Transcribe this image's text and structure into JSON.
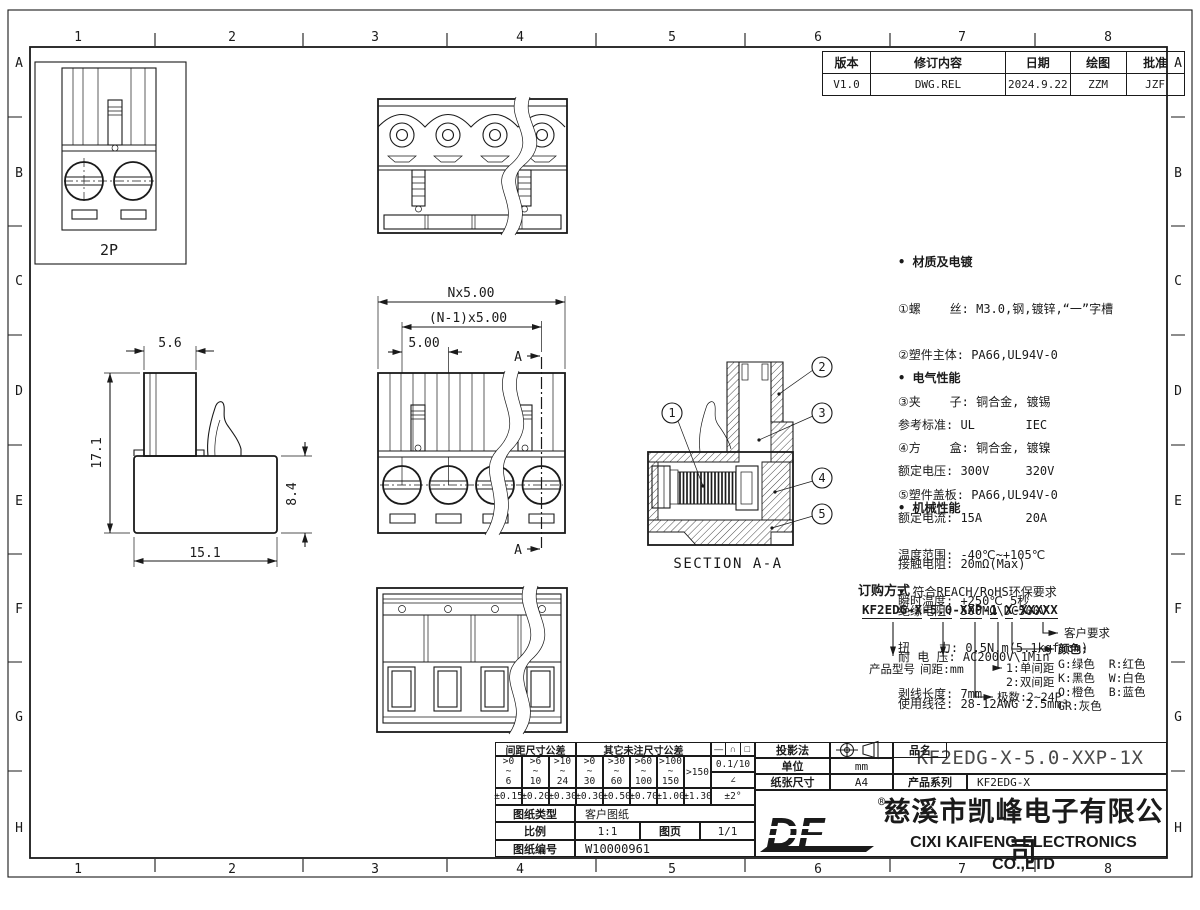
{
  "colors": {
    "ink": "#1a1a1a",
    "paper": "#ffffff",
    "muted": "#4a4a4a"
  },
  "grid": {
    "cols": [
      "1",
      "2",
      "3",
      "4",
      "5",
      "6",
      "7",
      "8"
    ],
    "rows": [
      "A",
      "B",
      "C",
      "D",
      "E",
      "F",
      "G",
      "H"
    ]
  },
  "revision": {
    "headers": [
      "版本",
      "修订内容",
      "日期",
      "绘图",
      "批准"
    ],
    "row": [
      "V1.0",
      "DWG.REL",
      "2024.9.22",
      "ZZM",
      "JZF"
    ]
  },
  "views": {
    "pole_label": "2P",
    "dim_top_width": "5.6",
    "dim_height": "17.1",
    "dim_body_height": "8.4",
    "dim_body_width": "15.1",
    "dim_overall": "Nx5.00",
    "dim_span": "(N-1)x5.00",
    "dim_pitch": "5.00",
    "section_mark": "A",
    "section_title": "SECTION A-A",
    "callouts": [
      "1",
      "2",
      "3",
      "4",
      "5"
    ]
  },
  "notes": {
    "bullet": "•",
    "material_title": "材质及电镀",
    "material_lines": [
      "①螺    丝: M3.0,钢,镀锌,“一”字槽",
      "②塑件主体: PA66,UL94V-0",
      "③夹    子: 铜合金, 镀锡",
      "④方    盒: 铜合金, 镀镍",
      "⑤塑件盖板: PA66,UL94V-0"
    ],
    "electrical_title": "电气性能",
    "electrical_lines": [
      "参考标准: UL       IEC",
      "额定电压: 300V     320V",
      "额定电流: 15A      20A",
      "接触电阻: 20mΩ(Max)",
      "绝缘电阻: 500MΩ\\DC500V",
      "耐 电 压: AC2000V\\1Min",
      "使用线径: 28-12AWG 2.5mm²"
    ],
    "mechanical_title": "机械性能",
    "mechanical_lines": [
      "温度范围: -40℃~+105℃",
      "瞬时温度: +250℃ 5秒",
      "扭    力: 0.5N.m(5.1kgf.cm)",
      "剥线长度: 7mm"
    ],
    "compliance": "符合REACH/RoHS环保要求"
  },
  "ordering": {
    "title": "订购方式",
    "part_segments": [
      "KF2EDG-X",
      "5.0",
      "XXP",
      "1",
      "X",
      "XXXXX"
    ],
    "dash": "-",
    "space": " ",
    "customer": "客户要求",
    "color_title": "颜色:",
    "color_lines": [
      "G:绿色  R:红色",
      "K:黑色  W:白色",
      "O:橙色  B:蓝色",
      "GR:灰色"
    ],
    "pitch_single": "1:单间距",
    "pitch_double": "2:双间距",
    "poles": "极数:2~24P",
    "model": "产品型号",
    "pitch_unit": "间距:mm"
  },
  "title_block": {
    "tol_pitch_header": "间距尺寸公差",
    "tol_other_header": "其它未注尺寸公差",
    "range_tops": [
      ">0",
      ">6",
      ">10",
      ">0",
      ">30",
      ">60",
      ">100"
    ],
    "tilde": "~",
    "range_bots": [
      "6",
      "10",
      "24",
      "30",
      "60",
      "100",
      "150"
    ],
    "range_over": ">150",
    "tols": [
      "±0.15",
      "±0.20",
      "±0.30",
      "±0.30",
      "±0.50",
      "±0.70",
      "±1.00",
      "±1.30"
    ],
    "sym_line": "—",
    "sym_arc": "∩",
    "sym_square": "□",
    "flatness": "0.1/10",
    "angle_sym": "∠",
    "angle_tol": "±2°",
    "doc_type_label": "图纸类型",
    "doc_type": "客户图纸",
    "scale_label": "比例",
    "scale": "1:1",
    "sheet_label": "图页",
    "sheet_no": "1/1",
    "doc_no_label": "图纸编号",
    "doc_no": "W10000961",
    "projection_label": "投影法",
    "unit_label": "单位",
    "unit": "mm",
    "paper_label": "纸张尺寸",
    "paper": "A4",
    "product_label": "品名",
    "product": "KF2EDG-X-5.0-XXP-1X",
    "series_label": "产品系列",
    "series": "KF2EDG-X",
    "logo": "DF",
    "reg": "®",
    "company_cn": "慈溪市凯峰电子有限公司",
    "company_en": "CIXI KAIFENG ELECTRONICS CO.,LTD"
  }
}
